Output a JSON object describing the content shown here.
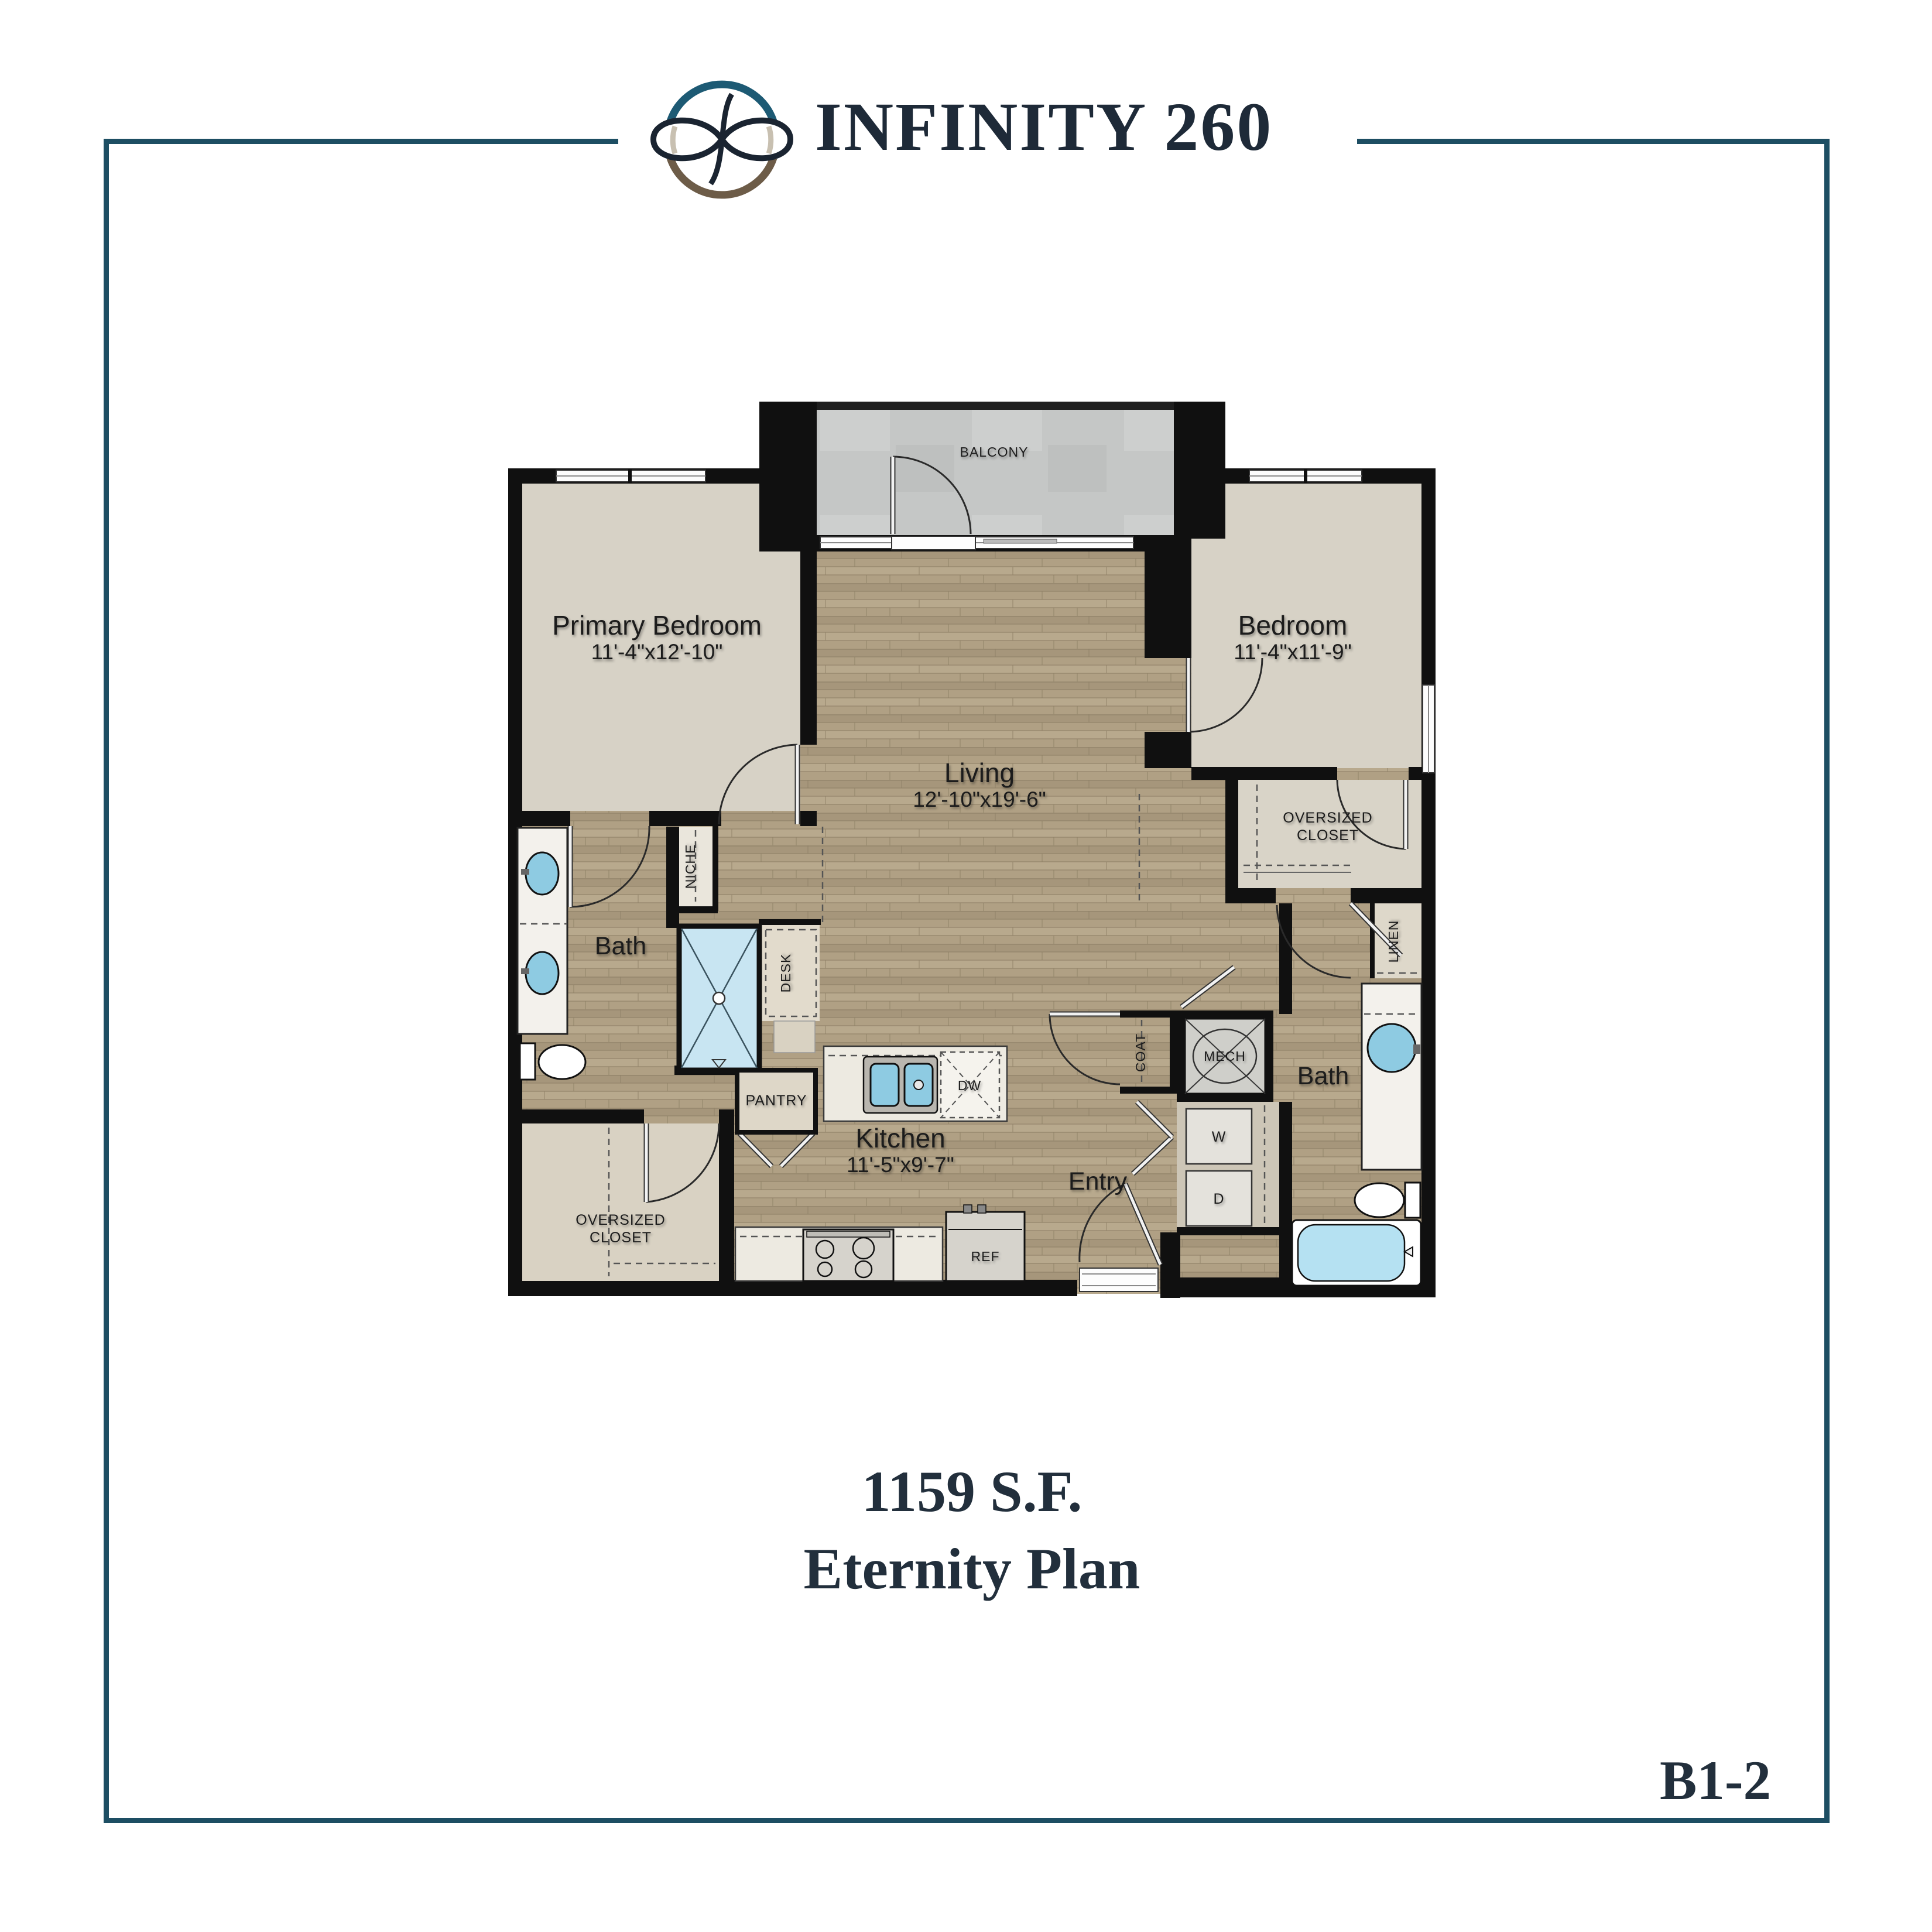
{
  "page": {
    "plan_code": "B1-2"
  },
  "header": {
    "title": "INFINITY 260",
    "logo": "infinity-ellipse-logo"
  },
  "footer": {
    "area": "1159 S.F.",
    "plan_name": "Eternity Plan"
  },
  "colors": {
    "frame_teal": "#1d4e63",
    "logo_teal": "#1d5a74",
    "logo_brown": "#6d5c48",
    "text_navy": "#222f3c",
    "wall_black": "#101010",
    "wood_floor": "#b0a084",
    "carpet": "#d7d2c6",
    "fixture_blue": "#8ecbe2",
    "concrete": "#c5c7c6"
  },
  "plan": {
    "balcony": {
      "label": "BALCONY"
    },
    "primary_bedroom": {
      "label": "Primary Bedroom",
      "dims": "11'-4\"x12'-10\""
    },
    "bedroom": {
      "label": "Bedroom",
      "dims": "11'-4\"x11'-9\""
    },
    "living": {
      "label": "Living",
      "dims": "12'-10\"x19'-6\""
    },
    "kitchen": {
      "label": "Kitchen",
      "dims": "11'-5\"x9'-7\""
    },
    "entry": {
      "label": "Entry"
    },
    "bath_primary": {
      "label": "Bath"
    },
    "bath_second": {
      "label": "Bath"
    },
    "closet_primary": {
      "line1": "OVERSIZED",
      "line2": "CLOSET"
    },
    "closet_second": {
      "line1": "OVERSIZED",
      "line2": "CLOSET"
    },
    "pantry": {
      "label": "PANTRY"
    },
    "niche": {
      "label": "NICHE"
    },
    "desk": {
      "label": "DESK"
    },
    "coat": {
      "label": "COAT"
    },
    "linen": {
      "label": "LINEN"
    },
    "mech": {
      "label": "MECH"
    },
    "washer": {
      "label": "W"
    },
    "dryer": {
      "label": "D"
    },
    "dishwasher": {
      "label": "DW"
    },
    "refrigerator": {
      "label": "REF"
    }
  }
}
